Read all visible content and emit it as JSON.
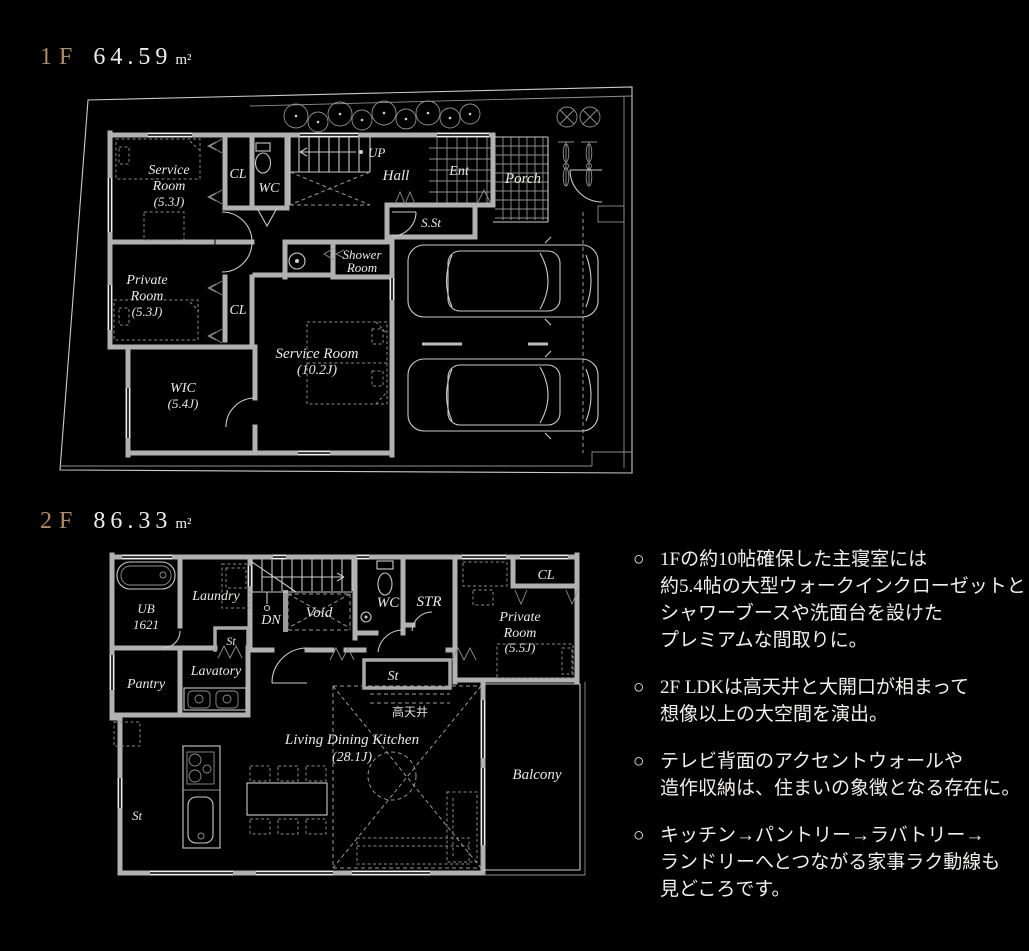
{
  "page": {
    "background": "#000000",
    "accent_color": "#b18a5e",
    "text_color": "#f1f0ec"
  },
  "floor_1f": {
    "label": "1F",
    "area": "64.59",
    "area_unit": "m²",
    "rooms": {
      "service_a_1": "Service",
      "service_a_2": "Room",
      "service_a_size": "(5.3J)",
      "cl_1": "CL",
      "wc": "WC",
      "up": "UP",
      "hall": "Hall",
      "ent": "Ent",
      "porch": "Porch",
      "sst": "S.St",
      "shower_1": "Shower",
      "shower_2": "Room",
      "private_1": "Private",
      "private_2": "Room",
      "private_size": "(5.3J)",
      "cl_2": "CL",
      "wic_1": "WIC",
      "wic_size": "(5.4J)",
      "service_b_1": "Service Room",
      "service_b_size": "(10.2J)"
    }
  },
  "floor_2f": {
    "label": "2F",
    "area": "86.33",
    "area_unit": "m²",
    "rooms": {
      "ub_1": "UB",
      "ub_2": "1621",
      "laundry": "Laundry",
      "dn": "DN",
      "void": "Void",
      "wc": "WC",
      "str": "STR",
      "cl": "CL",
      "private_1": "Private",
      "private_2": "Room",
      "private_size": "(5.5J)",
      "st_1": "St",
      "lavatory": "Lavatory",
      "pantry": "Pantry",
      "st_2": "St",
      "high_ceiling": "高天井",
      "ldk_1": "Living Dining Kitchen",
      "ldk_size": "(28.1J)",
      "balcony": "Balcony",
      "st_3": "St"
    }
  },
  "notes": [
    {
      "bullet": "○",
      "lines": [
        "1Fの約10帖確保した主寝室には",
        "約5.4帖の大型ウォークインクローゼットと",
        "シャワーブースや洗面台を設けた",
        "プレミアムな間取りに。"
      ]
    },
    {
      "bullet": "○",
      "lines": [
        "2F LDKは高天井と大開口が相まって",
        "想像以上の大空間を演出。"
      ]
    },
    {
      "bullet": "○",
      "lines": [
        "テレビ背面のアクセントウォールや",
        "造作収納は、住まいの象徴となる存在に。"
      ]
    },
    {
      "bullet": "○",
      "lines": [
        "キッチン→パントリー→ラバトリー→",
        "ランドリーへとつながる家事ラク動線も",
        "見どころです。"
      ]
    }
  ]
}
